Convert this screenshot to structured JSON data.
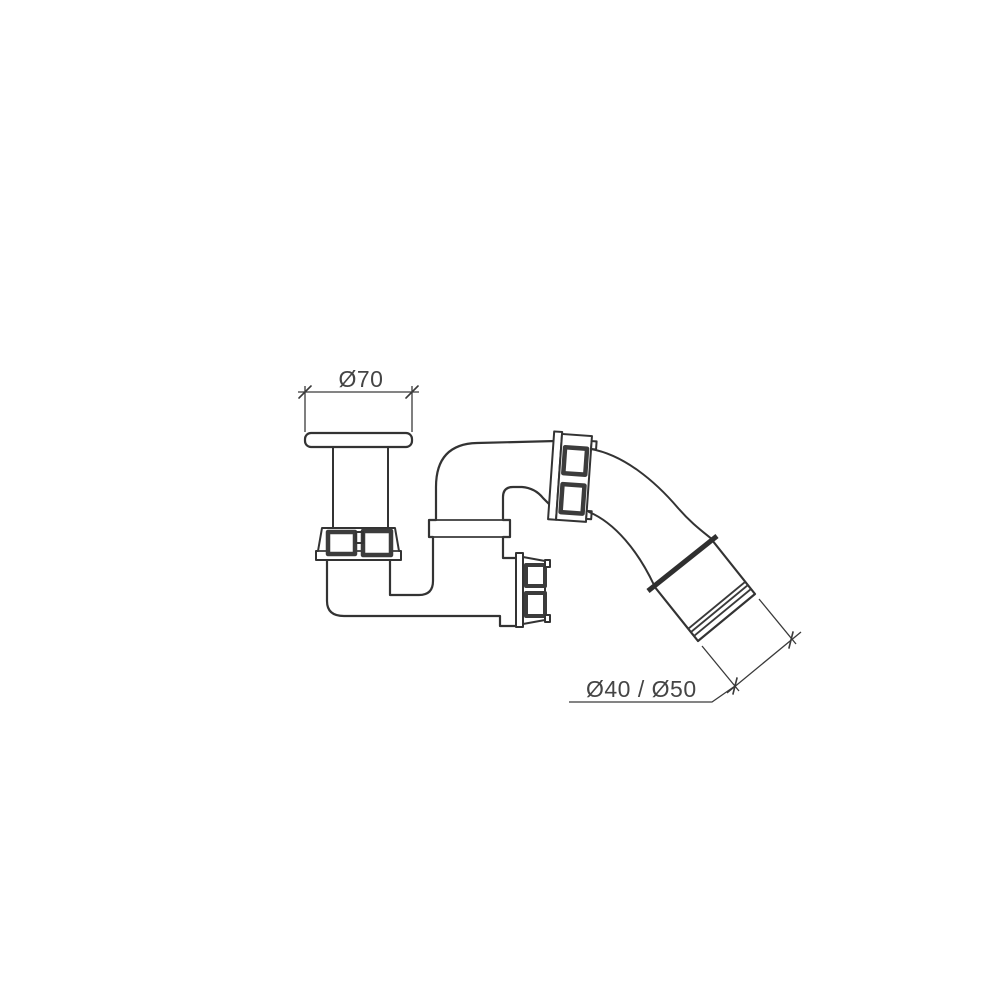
{
  "page": {
    "background_color": "#ffffff"
  },
  "drawing": {
    "kind": "technical-line-drawing",
    "line_color": "#333333",
    "facet_color": "#3c3c3c",
    "text_color": "#454545",
    "annotations": {
      "flange_diameter": {
        "label": "Ø70"
      },
      "outlet_diameter": {
        "label": "Ø40 / Ø50"
      }
    },
    "parts": [
      "drain-flange",
      "tailpipe",
      "inlet-union-nut",
      "trap-body",
      "riser-collar",
      "elbow",
      "elbow-union-nut",
      "side-outlet-nut",
      "flexible-outlet-pipe",
      "outlet-sleeve"
    ]
  }
}
